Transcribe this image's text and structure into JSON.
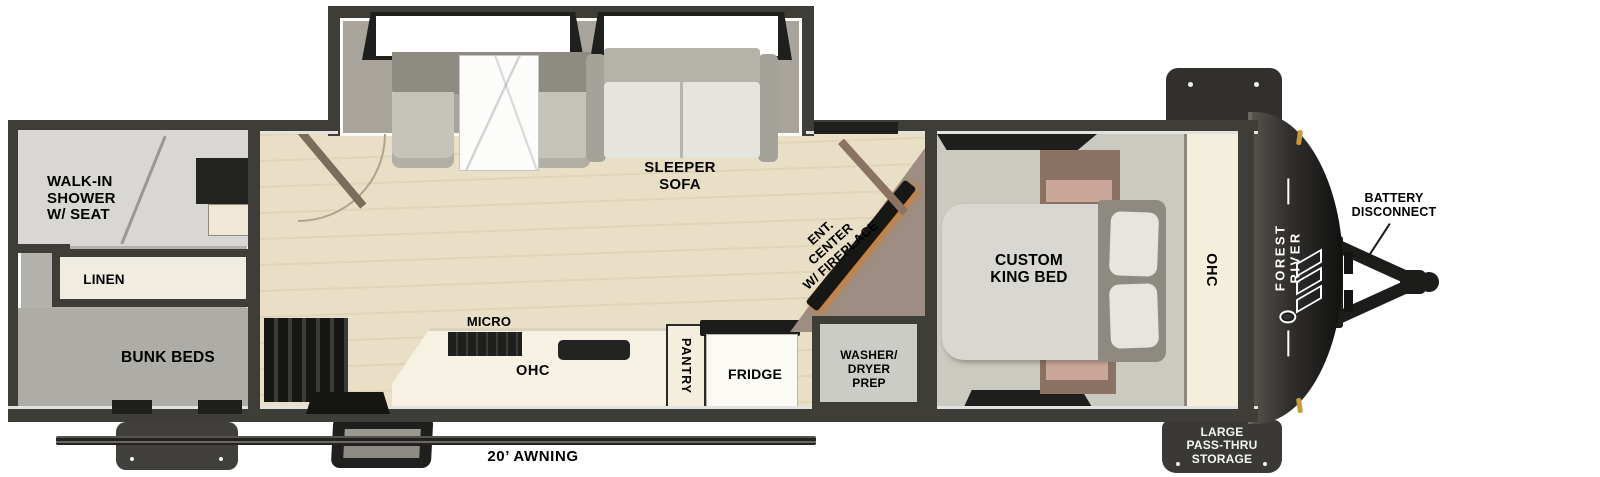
{
  "title": "Forest River travel trailer floor plan",
  "colors": {
    "wall": "#3f3d38",
    "wood_floor": "#e9dfc6",
    "slide_floor": "#a8a49b",
    "rear_floor": "#b3b1ab",
    "bedroom_floor": "#cbcac1",
    "cream_cabinet": "#f4eedd",
    "appliance_dark": "#1f1f1e",
    "ent_center_taupe": "#9d8d82",
    "fireplace_glow": "#d97c25",
    "front_cap": "#262522",
    "external_tab": "#3a3937",
    "clearance_light_amber": "#c79b3a",
    "label_text": "#161614",
    "tab_label_text": "#f4f4f1"
  },
  "labels": {
    "walk_in_shower": "WALK-IN\nSHOWER\nW/ SEAT",
    "linen": "LINEN",
    "bunk_beds": "BUNK BEDS",
    "sleeper_sofa": "SLEEPER\nSOFA",
    "micro": "MICRO",
    "kitchen_ohc": "OHC",
    "pantry": "PANTRY",
    "fridge": "FRIDGE",
    "ent_center": "ENT.\nCENTER\nW/ FIREPLACE",
    "washer_dryer": "WASHER/\nDRYER\nPREP",
    "king_bed": "CUSTOM\nKING BED",
    "bedroom_ohc": "OHC",
    "battery_disconnect": "BATTERY\nDISCONNECT",
    "pass_thru": "LARGE\nPASS-THRU\nSTORAGE",
    "awning": "20’ AWNING",
    "brand": "FOREST RIVER"
  }
}
